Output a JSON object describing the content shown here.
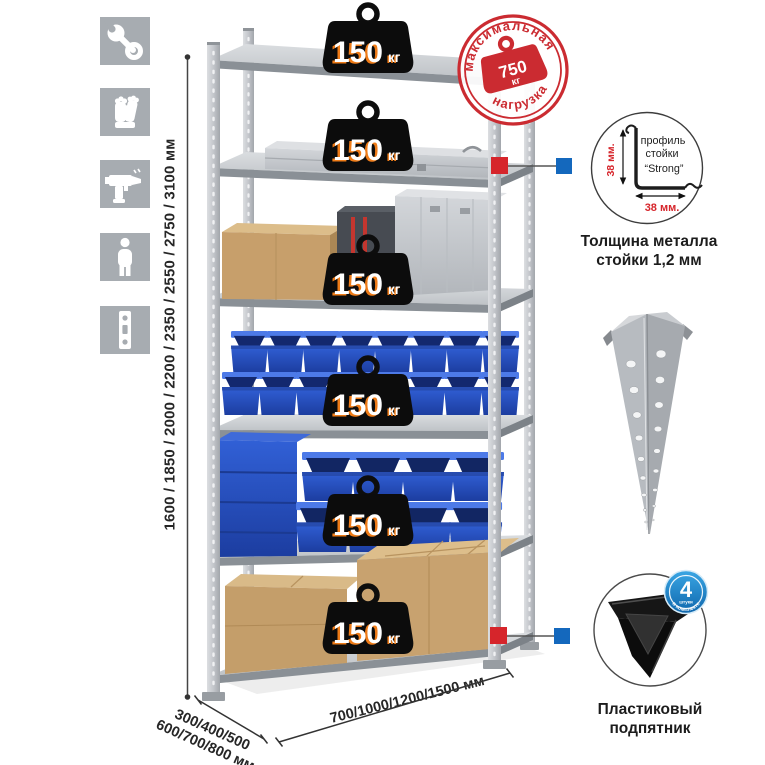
{
  "colors": {
    "accent_red": "#d6252b",
    "accent_blue": "#1468bd",
    "stamp_red": "#cb2b31",
    "bin_blue": "#2a55c8",
    "badge_blue": "#1f8ccc",
    "metal_gray": "#b9bdc2"
  },
  "sidebar": {
    "icons": [
      {
        "name": "wrench"
      },
      {
        "name": "gloves"
      },
      {
        "name": "drill"
      },
      {
        "name": "person"
      },
      {
        "name": "post-strip"
      }
    ]
  },
  "rack": {
    "shelf_count": 6,
    "shelf_load": {
      "value": "150",
      "unit": "кг"
    }
  },
  "stamp": {
    "arc_top": "максимальная",
    "arc_bottom": "нагрузка",
    "value": "750",
    "unit": "кг"
  },
  "dimensions": {
    "height": "1600 / 1850 / 2000 / 2200 / 2350 / 2550 / 2750 / 3100 мм",
    "depth_line1": "300/400/500",
    "depth_line2": "600/700/800 мм",
    "width": "700/1000/1200/1500 мм"
  },
  "profile_detail": {
    "line1": "профиль",
    "line2": "стойки",
    "line3": "“Strong”",
    "dim_v": "38 мм.",
    "dim_h": "38 мм.",
    "caption1": "Толщина металла",
    "caption2": "стойки 1,2 мм"
  },
  "foot_detail": {
    "badge_count": "4",
    "badge_unit": "штуки",
    "badge_arc": "в комплекте",
    "caption1": "Пластиковый",
    "caption2": "подпятник"
  }
}
